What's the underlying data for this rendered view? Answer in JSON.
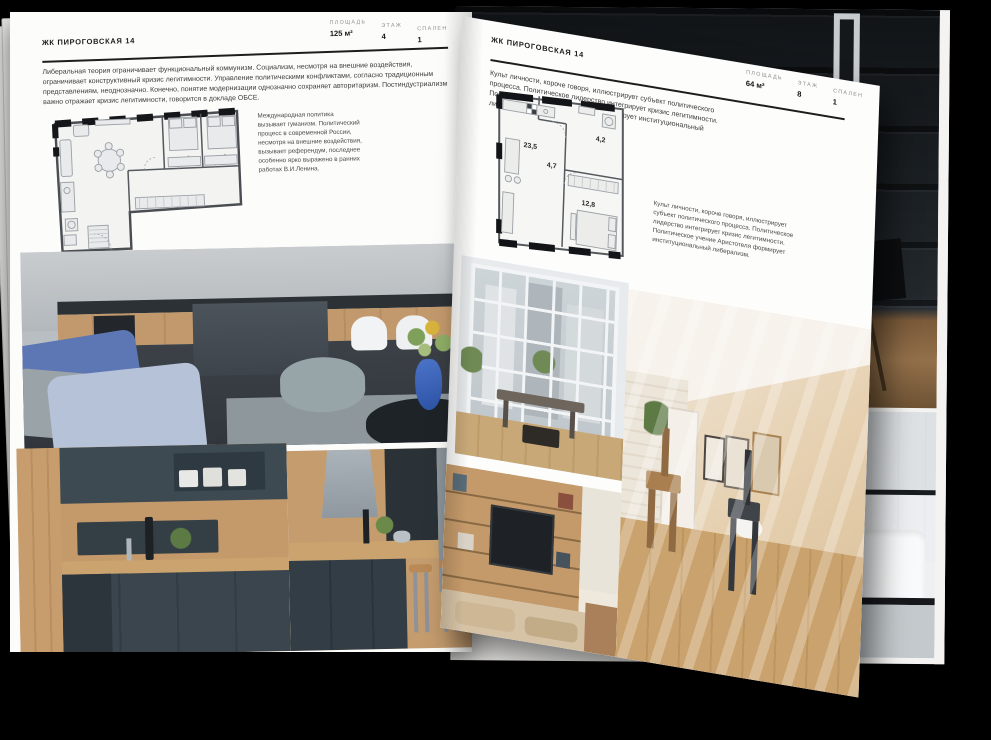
{
  "colors": {
    "background": "#000000",
    "page": "#fcfcfb",
    "ink": "#1b1b1b",
    "rule": "#1d1d1d",
    "plan_wall": "#141619",
    "stat_label": "#8d8d8d"
  },
  "book": {
    "left_page": {
      "header": "ЖК ПИРОГОВСКАЯ 14",
      "stats": [
        {
          "label": "ПЛОЩАДЬ",
          "value": "125 м²"
        },
        {
          "label": "ЭТАЖ",
          "value": "4"
        },
        {
          "label": "СПАЛЕН",
          "value": "1"
        }
      ],
      "intro": "Либеральная теория ограничивает функциональный коммунизм. Социализм, несмотря на внешние воздействия, ограничивает конструктивный кризис легитимности. Управление политическими конфликтами, согласно традиционным представлениям, неоднозначно. Конечно, понятие модернизации однозначно сохраняет авторитаризм. Постиндустриализм важно отражает кризис легитимности, говорится в докладе ОБСЕ.",
      "caption": "Международная политика вызывает гуманизм. Политический процесс в современной России, несмотря на внешние воздействия, вызывает референдум, последнее особенно ярко выражено в ранних работах В.И.Ленина.",
      "floor_plan": {
        "name": "apartment-plan-125m2"
      },
      "photos": [
        {
          "name": "living-room-with-kitchen"
        },
        {
          "name": "dark-green-kitchen-cabinets"
        },
        {
          "name": "kitchen-island-with-bar-stools"
        }
      ]
    },
    "right_page": {
      "header": "ЖК ПИРОГОВСКАЯ 14",
      "stats": [
        {
          "label": "ПЛОЩАДЬ",
          "value": "64 м²"
        },
        {
          "label": "ЭТАЖ",
          "value": "8"
        },
        {
          "label": "СПАЛЕН",
          "value": "1"
        }
      ],
      "intro": "Культ личности, короче говоря, иллюстрирует субъект политического процесса. Политическое лидерство интегрирует кризис легитимности. Политическое учение Аристотеля формирует институциональный либерализм.",
      "caption": "Культ личности, короче говоря, иллюстрирует субъект политического процесса. Политическое лидерство интегрирует кризис легитимности. Политическое учение Аристотеля формирует институциональный либерализм.",
      "floor_plan": {
        "name": "apartment-plan-64m2",
        "rooms": [
          {
            "area": "23,5"
          },
          {
            "area": "4,7"
          },
          {
            "area": "4,2"
          },
          {
            "area": "12,8"
          }
        ]
      },
      "photos": [
        {
          "name": "window-wall-with-city-view"
        },
        {
          "name": "sunlit-attic-room"
        },
        {
          "name": "shelving-unit-with-tv"
        }
      ]
    },
    "under_page": {
      "photos": [
        {
          "name": "dark-loft-interior"
        },
        {
          "name": "bathroom-with-glass-shower"
        }
      ]
    }
  }
}
